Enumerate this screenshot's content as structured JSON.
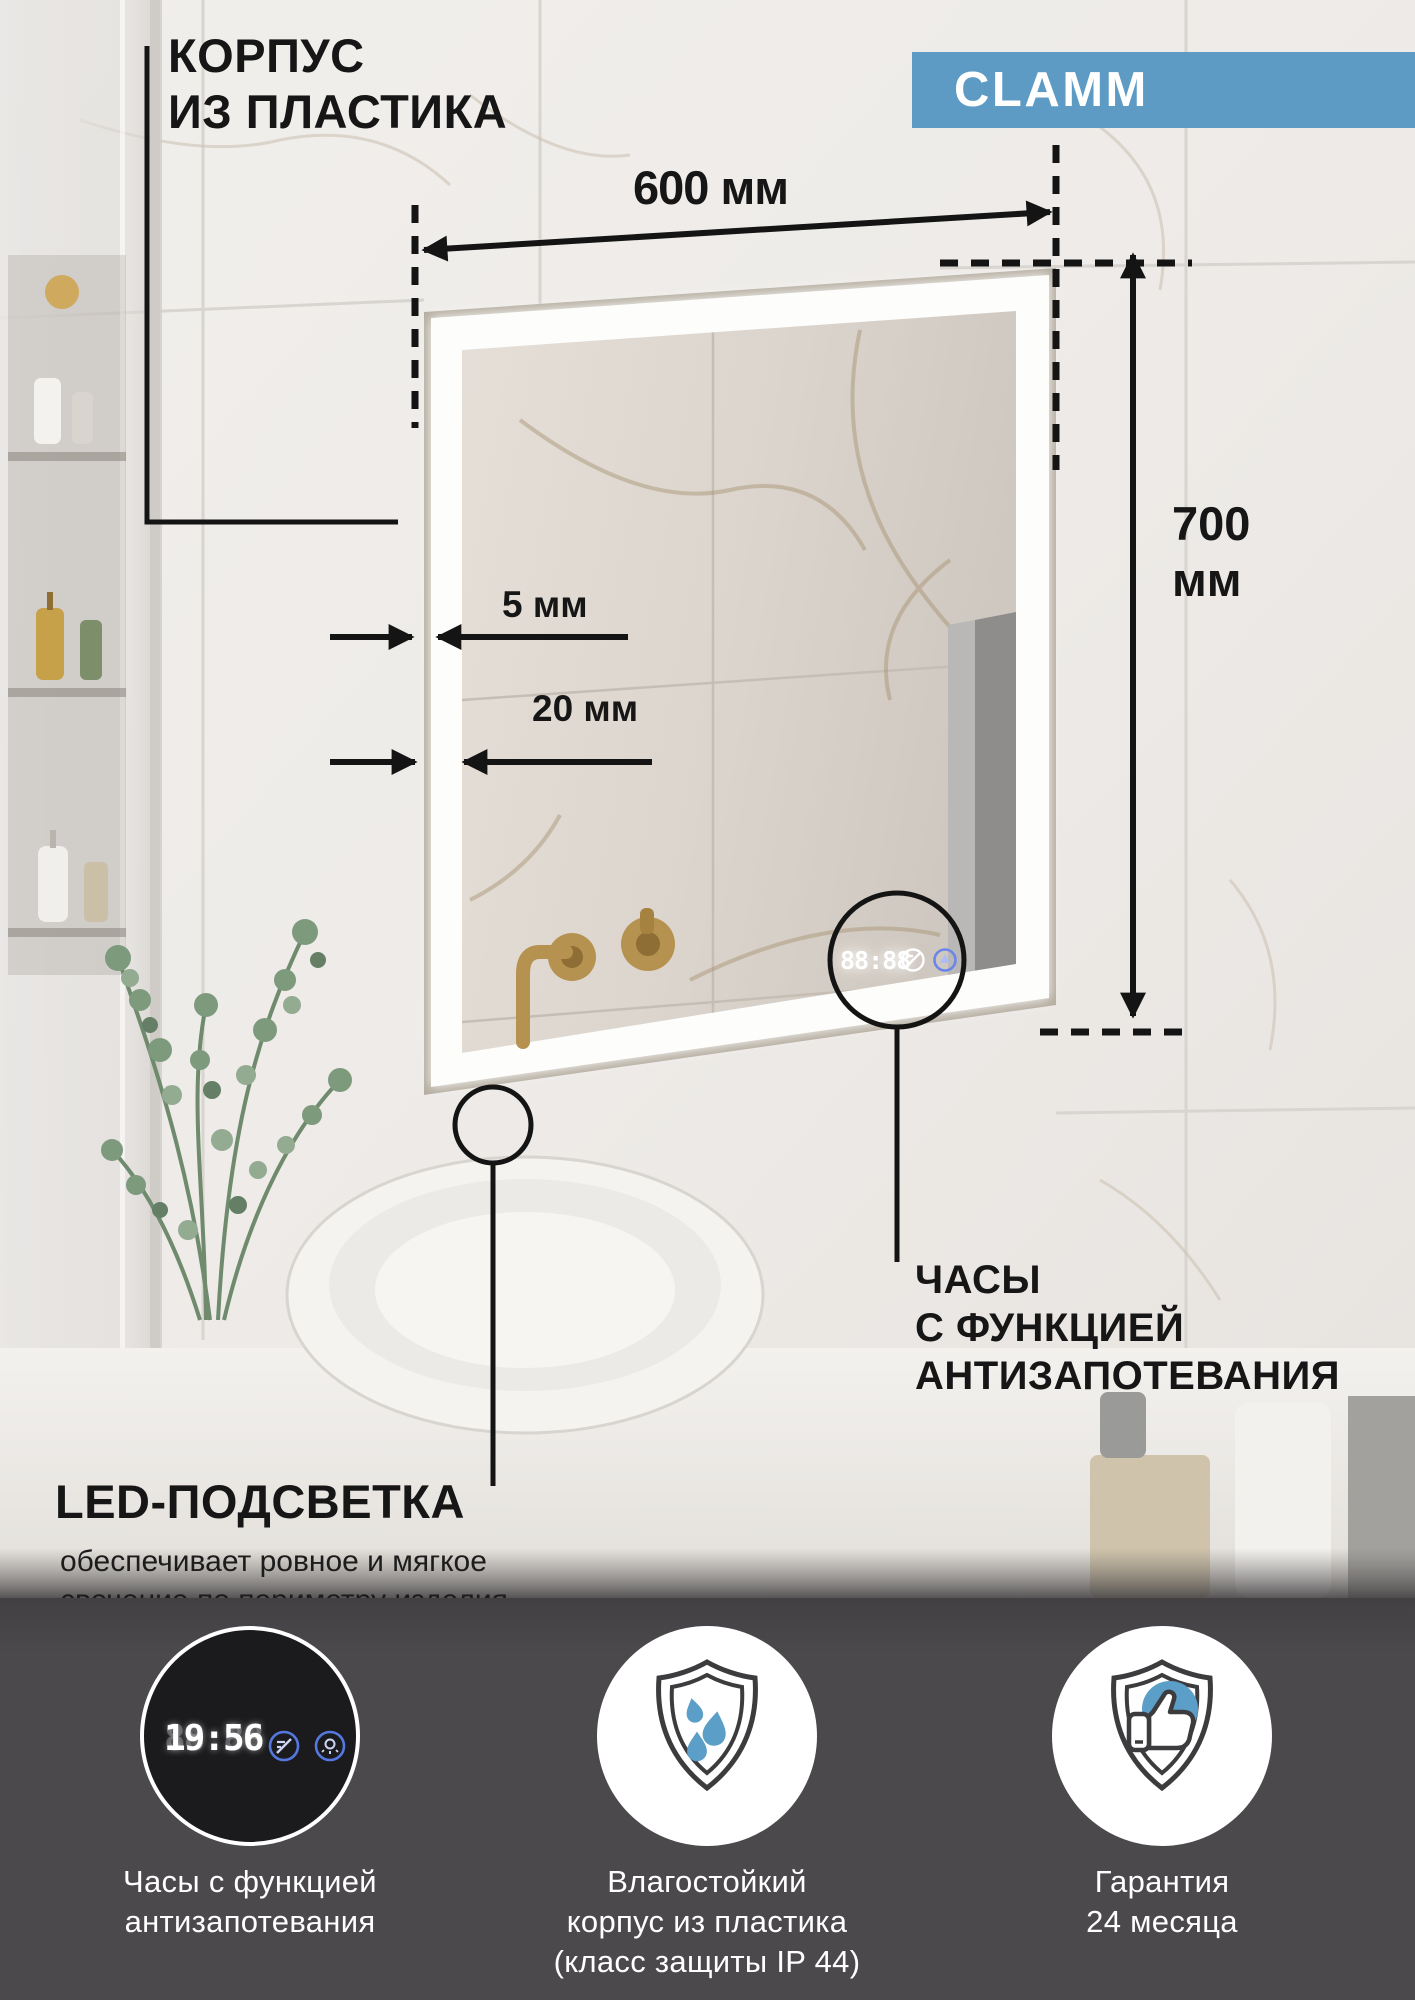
{
  "badge": {
    "label": "CLAMM",
    "color": "#5d9bc4"
  },
  "callouts": {
    "body": {
      "line1": "КОРПУС",
      "line2": "ИЗ ПЛАСТИКА"
    },
    "led": {
      "title": "LED-ПОДСВЕТКА",
      "desc1": "обеспечивает ровное и мягкое",
      "desc2": "свечение по периметру изделия"
    },
    "clock": {
      "line1": "ЧАСЫ",
      "line2": "С ФУНКЦИЕЙ",
      "line3": "АНТИЗАПОТЕВАНИЯ"
    }
  },
  "dimensions": {
    "width": "600 мм",
    "height_line1": "700",
    "height_line2": "мм",
    "frame": "5 мм",
    "led_band": "20 мм"
  },
  "mirror_display": {
    "time": "88:88"
  },
  "footer": {
    "background": "#4b494c",
    "features": [
      {
        "icon": "clock-display",
        "ghost": "88:88",
        "time": "19:56",
        "caption1": "Часы с функцией",
        "caption2": "антизапотевания"
      },
      {
        "icon": "shield-drops",
        "caption1": "Влагостойкий",
        "caption2": "корпус из пластика",
        "caption3": "(класс защиты IP 44)"
      },
      {
        "icon": "shield-thumb",
        "caption1": "Гарантия",
        "caption2": "24 месяца"
      }
    ]
  },
  "colors": {
    "accent_blue": "#5d9bc4",
    "icon_blue": "#5b9ec7",
    "led_icon_blue": "#5478e0"
  }
}
